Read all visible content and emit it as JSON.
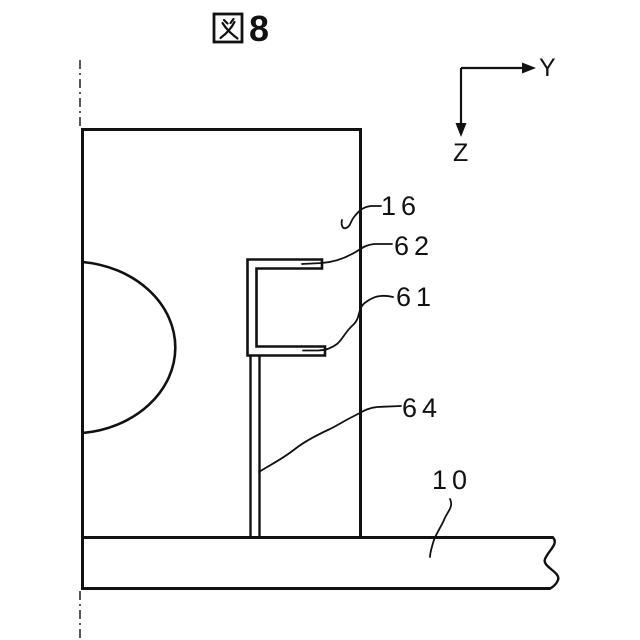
{
  "figure": {
    "title": "図8",
    "kanji": "図",
    "number": "8"
  },
  "axes": {
    "y_label": "Y",
    "z_label": "Z"
  },
  "reference_numerals": {
    "housing": "16",
    "upper_arm": "62",
    "lower_arm": "61",
    "support_plate": "64",
    "base_plate": "10"
  },
  "colors": {
    "ink": "#111111",
    "background": "#ffffff"
  }
}
